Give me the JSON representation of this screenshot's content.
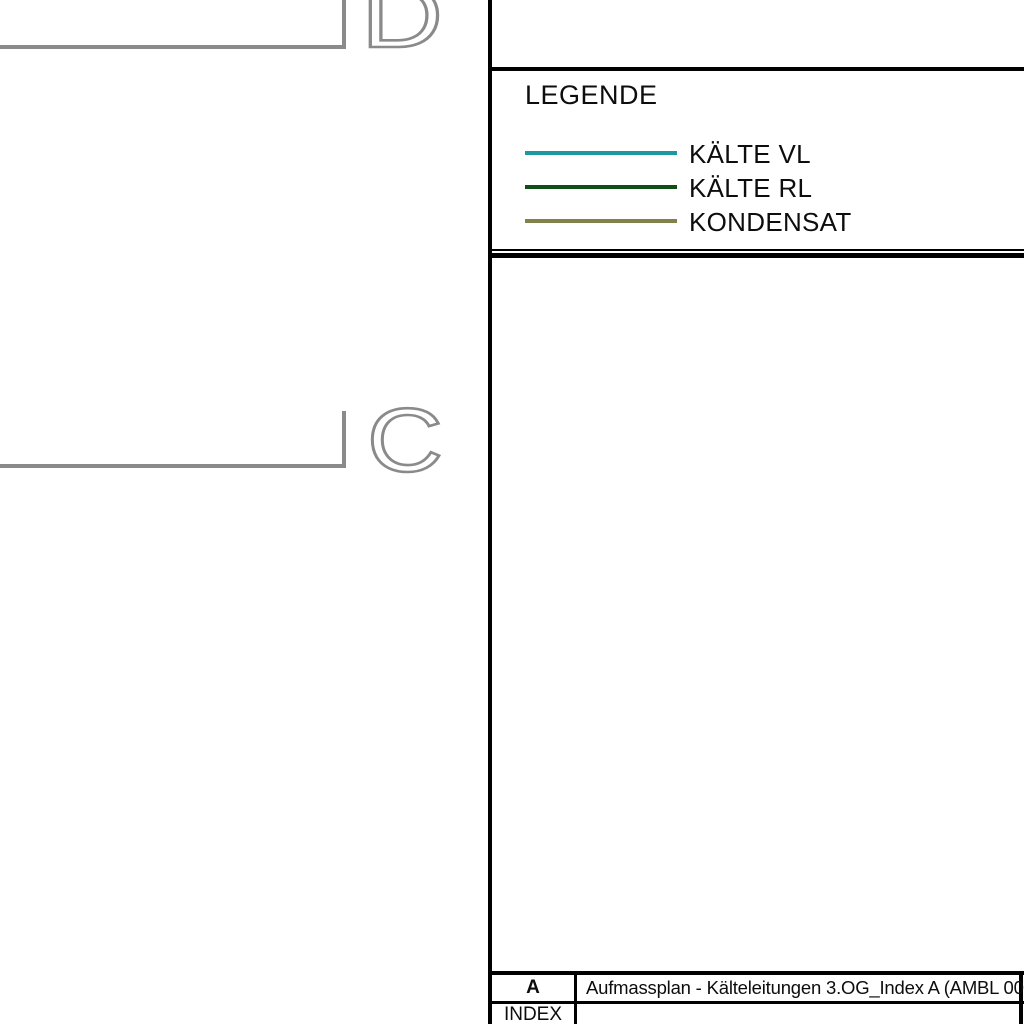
{
  "drawing": {
    "grid_labels": [
      {
        "letter": "D"
      },
      {
        "letter": "C"
      }
    ]
  },
  "legend": {
    "title": "LEGENDE",
    "items": [
      {
        "label": "KÄLTE VL",
        "color": "#1b98a1"
      },
      {
        "label": "KÄLTE RL",
        "color": "#0e4e17"
      },
      {
        "label": "KONDENSAT",
        "color": "#81814c"
      }
    ]
  },
  "title_block": {
    "revision_letter": "A",
    "revision_description": "Aufmassplan - Kälteleitungen 3.OG_Index A (AMBL 006)",
    "index_label": "INDEX"
  },
  "colors": {
    "grid_gray": "#8a8a8a",
    "border_black": "#000000"
  }
}
